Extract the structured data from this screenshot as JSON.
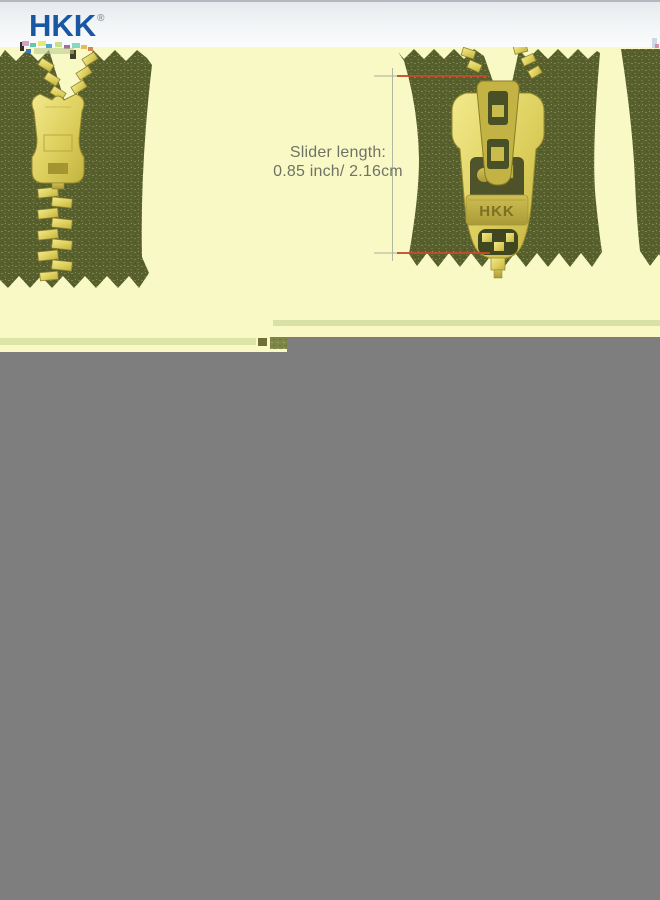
{
  "header": {
    "brand": "HKK",
    "registered": "®",
    "brand_color": "#1a57a3"
  },
  "product_image": {
    "background_color": "#f9f9c6",
    "annotation": {
      "line1": "Slider length:",
      "line2": "0.85 inch/ 2.16cm"
    },
    "slider_stamp": "HKK",
    "measure_line_color": "#c54b2d",
    "fabric_color": "#57602d",
    "brass_color": "#d9ca57",
    "tape_edge_stripe_color": "#dce5a5"
  },
  "placeholder": {
    "color": "#7e7e7e"
  }
}
